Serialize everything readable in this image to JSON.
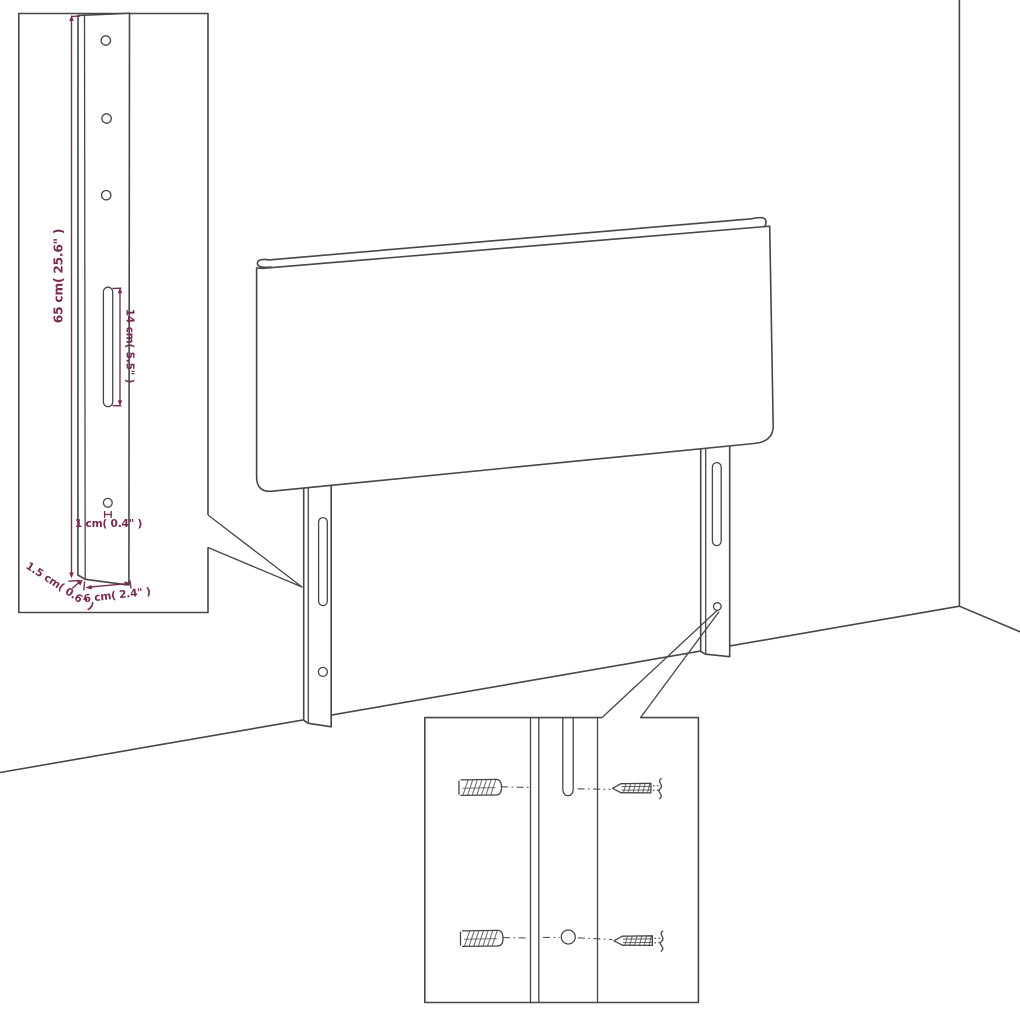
{
  "diagram": {
    "title": "Headboard mounting-leg dimension diagram",
    "subject": "upholstered headboard panel with two slotted wall-mount legs",
    "insets": {
      "left": "enlarged mounting leg with holes, slot and dimensions",
      "right": "enlarged hardware detail with wall plugs and screws"
    },
    "colors": {
      "line": "#47474b",
      "dimension_text": "#772b52",
      "background": "#ffffff"
    },
    "dimensions": {
      "leg_height": "65 cm( 25.6\" )",
      "slot_length": "14 cm( 5.5\" )",
      "hole_size": "1 cm( 0.4\" )",
      "leg_depth": "1.5 cm( 0.6\" )",
      "leg_width": "6 cm( 2.4\" )"
    }
  }
}
